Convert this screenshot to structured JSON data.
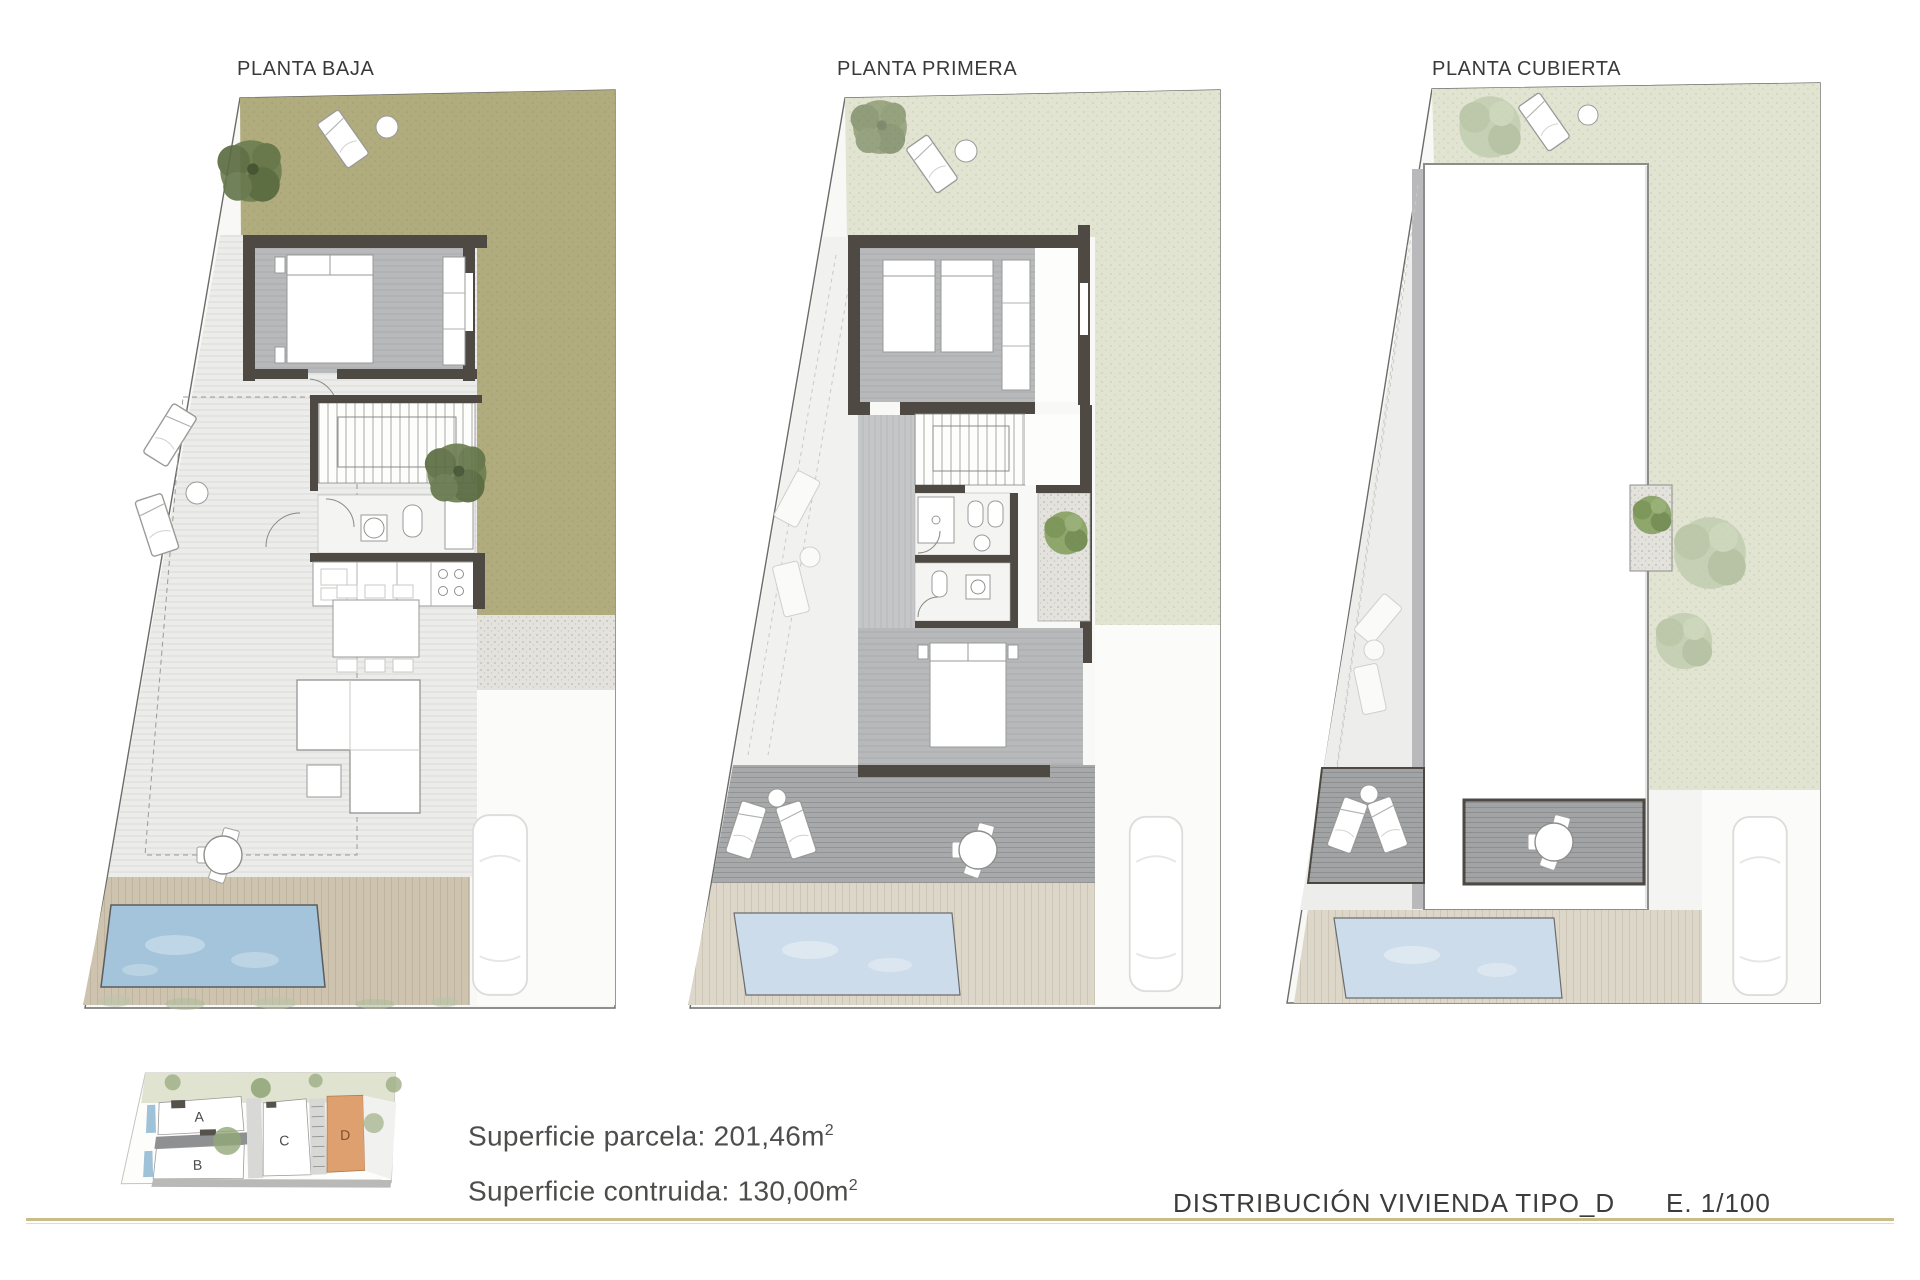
{
  "document": {
    "background": "#ffffff"
  },
  "plans": [
    {
      "id": "planta-baja",
      "label": "PLANTA BAJA"
    },
    {
      "id": "planta-primera",
      "label": "PLANTA PRIMERA"
    },
    {
      "id": "planta-cubierta",
      "label": "PLANTA CUBIERTA"
    }
  ],
  "site_key": {
    "units": [
      {
        "label": "A",
        "highlighted": false
      },
      {
        "label": "B",
        "highlighted": false
      },
      {
        "label": "C",
        "highlighted": false
      },
      {
        "label": "D",
        "highlighted": true
      }
    ]
  },
  "summary": {
    "line1": {
      "text": "Superficie parcela: 201,46m",
      "sup": "2"
    },
    "line2": {
      "text": "Superficie contruida: 130,00m",
      "sup": "2"
    }
  },
  "titleblock": {
    "title": "DISTRIBUCIÓN VIVIENDA TIPO_D",
    "scale": "E. 1/100"
  },
  "colors": {
    "garden_olive": "#b1ac7e",
    "garden_sage": "#e0e4d0",
    "paving_light": "#f7f7f5",
    "terrace_light": "#ececea",
    "terrace_dark": "#a2a3a4",
    "wall_dark": "#4e4a43",
    "floor_gray": "#b7b9ba",
    "pool_blue": "#a3c4da",
    "pool_blue_light": "#cddcea",
    "deck_tan": "#cdc3af",
    "deck_tan_light": "#ddd7ca",
    "gravel": "#e3e2dd",
    "tree_dark": "#64754a",
    "tree_pale": "#bcc8aa",
    "highlight_unit": "#dfa06f",
    "rule_line": "#cbbd87",
    "text": "#3d3d3c"
  }
}
